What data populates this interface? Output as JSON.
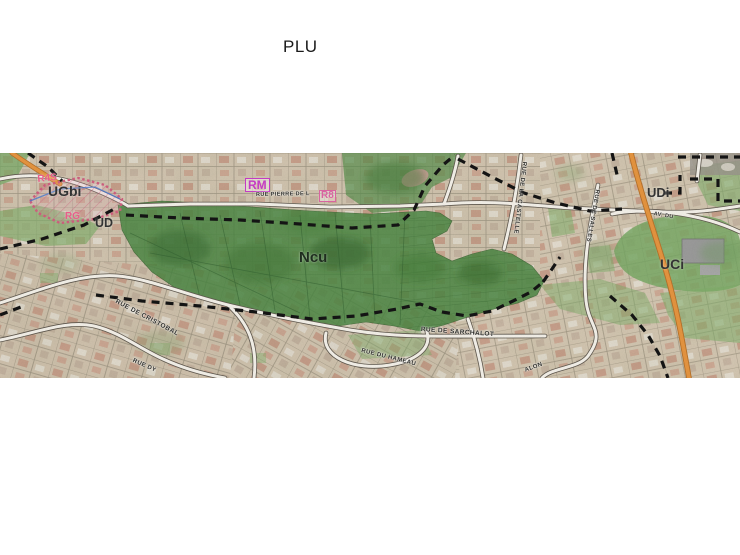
{
  "page": {
    "title": "PLU"
  },
  "map": {
    "type": "aerial-zoning-map",
    "zone_labels": {
      "ugbi": "UGbi",
      "ud": "UD",
      "ncu": "Ncu",
      "udi": "UDi",
      "uci": "UCi"
    },
    "reservation_labels": {
      "r4s": "R4S",
      "rg": "RG",
      "rm": "RM",
      "r8": "R8"
    },
    "street_labels": {
      "rue_pierre": "RUE PIERRE DE L",
      "castelle": "RUE DE LA CASTELLE",
      "salles": "RUE DE SALLES",
      "cristobal": "RUE DE CRISTOBAL",
      "sarchalot": "RUE DE SARCHALOT",
      "hameau": "RUE DU HAMEAU",
      "rue_dy": "RUE DY",
      "salon": "ALON",
      "av_du": "AV. DU"
    },
    "colors": {
      "natural_zone_green": "#478540",
      "light_green": "#7fae6a",
      "aerial_tan": "#d5c7b3",
      "boundary_black": "#141414",
      "road_orange": "#e69540",
      "reservation_pink": "#e85d8a",
      "reservation_magenta": "#c43bc4"
    }
  }
}
